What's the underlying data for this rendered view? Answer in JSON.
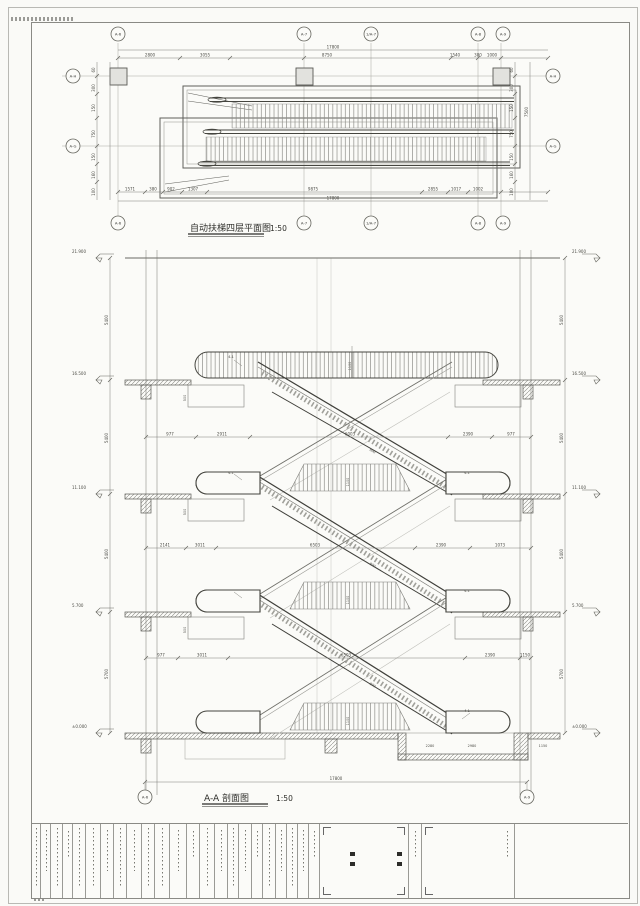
{
  "plan": {
    "title": "自动扶梯四层平面图",
    "scale": "1:50",
    "grid_cols": [
      "A-6",
      "A-7",
      "1/A-7",
      "A-8",
      "A-9"
    ],
    "grid_rows": [
      "A-H",
      "A-G"
    ],
    "overall_top": "17800",
    "overall_bottom": "17800",
    "dims_top": [
      "2800",
      "3055",
      "8750",
      "1540",
      "380",
      "1000"
    ],
    "dims_bottom": [
      "1571",
      "380",
      "902",
      "1307",
      "9875",
      "2855",
      "1017",
      "1002"
    ],
    "dims_left": [
      "60",
      "300",
      "150",
      "750",
      "150",
      "160",
      "100"
    ],
    "dims_right": [
      "60",
      "300",
      "150",
      "750",
      "150",
      "160",
      "100"
    ],
    "side_total": "7500"
  },
  "section": {
    "title": "A-A 剖面图",
    "scale": "1:50",
    "grid_bottom": [
      "A-6",
      "A-9"
    ],
    "levels": [
      "21.900",
      "16.500",
      "11.100",
      "5.700",
      "±0.000"
    ],
    "floor_gaps": [
      "5400",
      "5400",
      "5400",
      "5700"
    ],
    "overall_bottom": "17800",
    "chain1": [
      "977",
      "2911",
      "6003",
      "2390",
      "977"
    ],
    "chain2": [
      "2141",
      "3011",
      "6503",
      "2390",
      "1073"
    ],
    "chain3": [
      "977",
      "3011",
      "6503",
      "2390",
      "1150"
    ],
    "pit_dims": [
      "2280",
      "2980",
      "1150"
    ],
    "balustrade_dim": "1100",
    "incline_dim": "800",
    "beam_dim": "500",
    "detail_ref": "4-1"
  }
}
